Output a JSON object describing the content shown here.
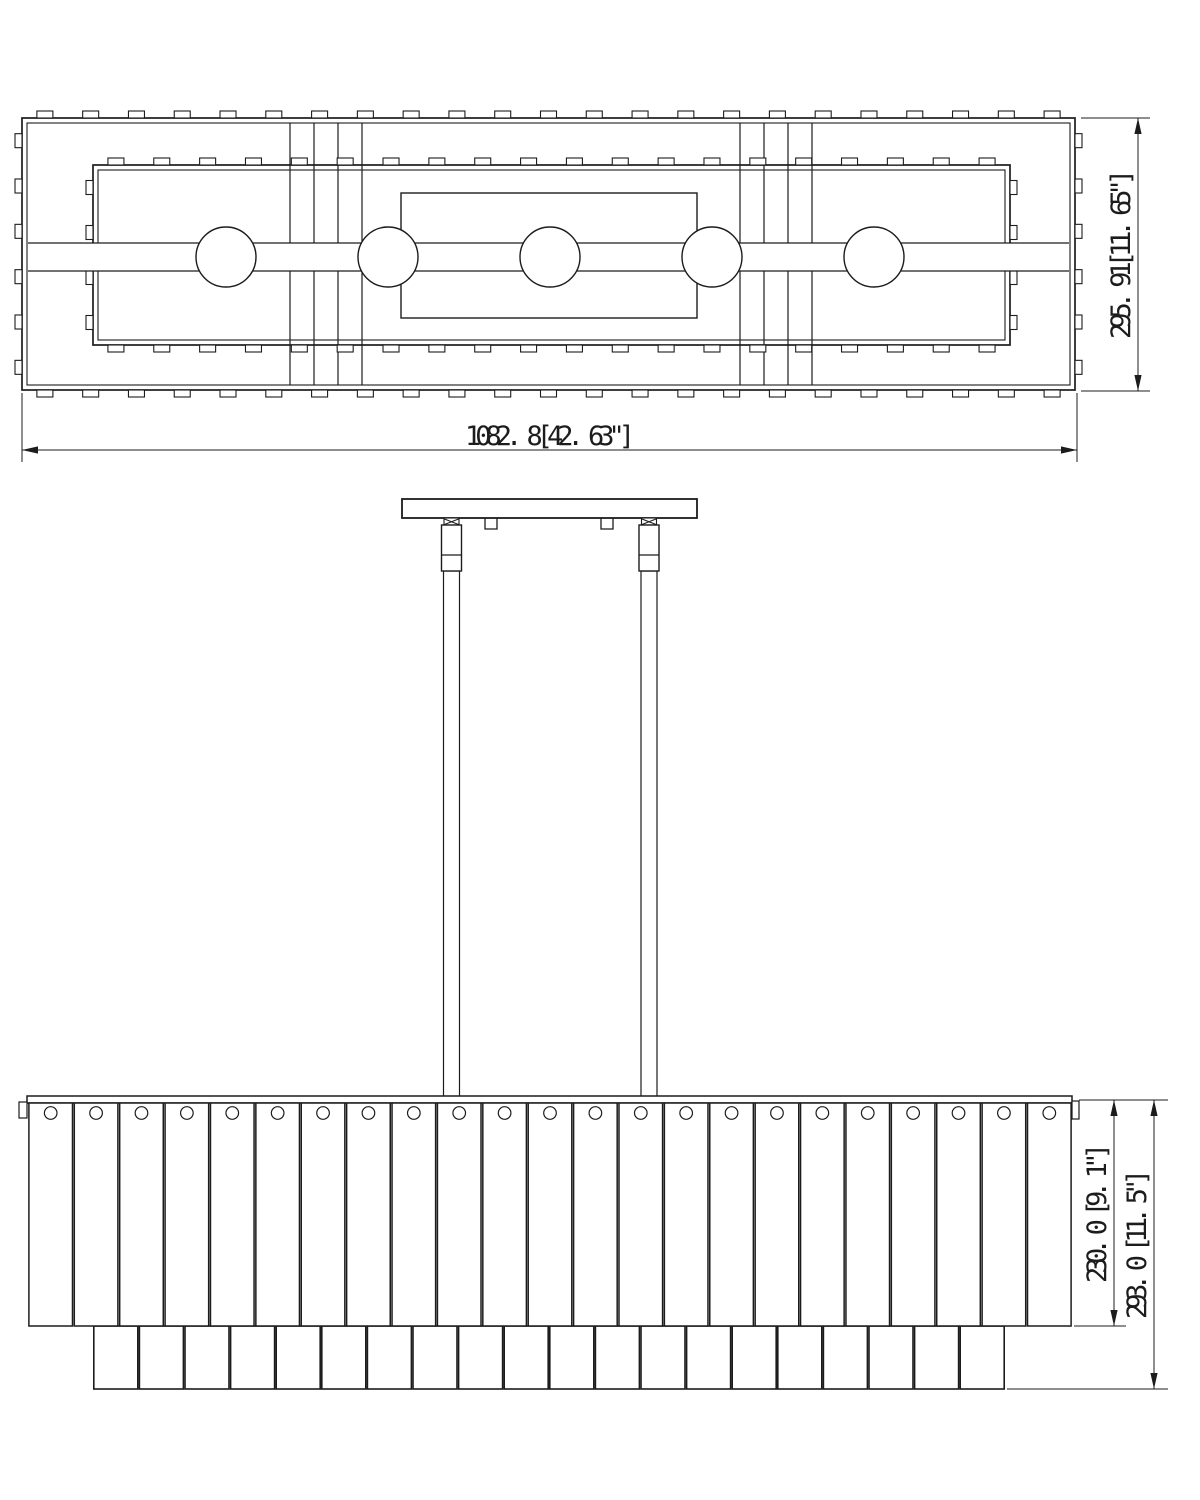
{
  "drawing": {
    "background_color": "#ffffff",
    "line_color": "#1c1c1c",
    "top_view": {
      "lamp_circle_count": 5,
      "cross_strap_groups": 2,
      "dim_width_label": "1082. 8[42. 63\"]",
      "dim_depth_label": "295. 91[11. 65\"]"
    },
    "front_view": {
      "rod_count": 2,
      "front_panel_count": 23,
      "back_panel_count": 20,
      "dim_shade_height_label": "230. 0 [9. 1\"]",
      "dim_overall_height_label": "293. 0 [11. 5\"]"
    }
  }
}
